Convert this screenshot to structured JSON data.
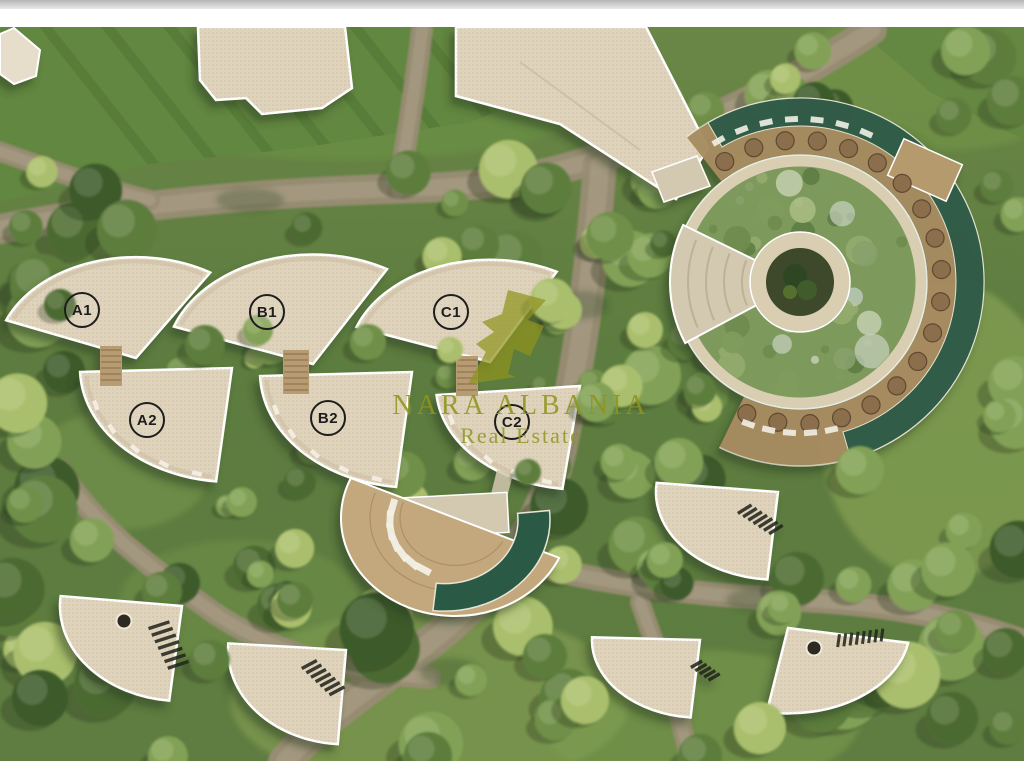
{
  "watermark": {
    "brand": "NARA ALBANIA",
    "tagline": "Real Estate",
    "color": "#8f941f",
    "logo_icon": "bird-monogram-logo"
  },
  "units": [
    {
      "label": "A1"
    },
    {
      "label": "B1"
    },
    {
      "label": "C1"
    },
    {
      "label": "A2"
    },
    {
      "label": "B2"
    },
    {
      "label": "C2"
    }
  ],
  "palette": {
    "border_gray": "#b5b5b5",
    "border_white": "#ffffff",
    "lawn": "#628740",
    "grass_light": "#7fa04f",
    "tree_dark": "#3c5a2b",
    "tree_mid": "#5d7d3d",
    "tree_light": "#82a156",
    "tree_bright": "#aabf6d",
    "road": "#998c75",
    "road_light": "#b3a78e",
    "roof_beige": "#dfd3bb",
    "roof_shade": "#c9bb9f",
    "parapet_white": "#ffffff",
    "pool_teal": "#2c5a45",
    "deck_wood": "#c2a87c",
    "clubhouse_deck": "#a68c60",
    "clubhouse_roof_green": "#7d995c",
    "umbrella_brown": "#8b6e4b",
    "courtyard_dark": "#3d4a2c",
    "plank_wood": "#b79b72",
    "stair_dark": "#23251c",
    "lounger_white": "#f2efe6",
    "label_ink": "#1d1d1d"
  }
}
